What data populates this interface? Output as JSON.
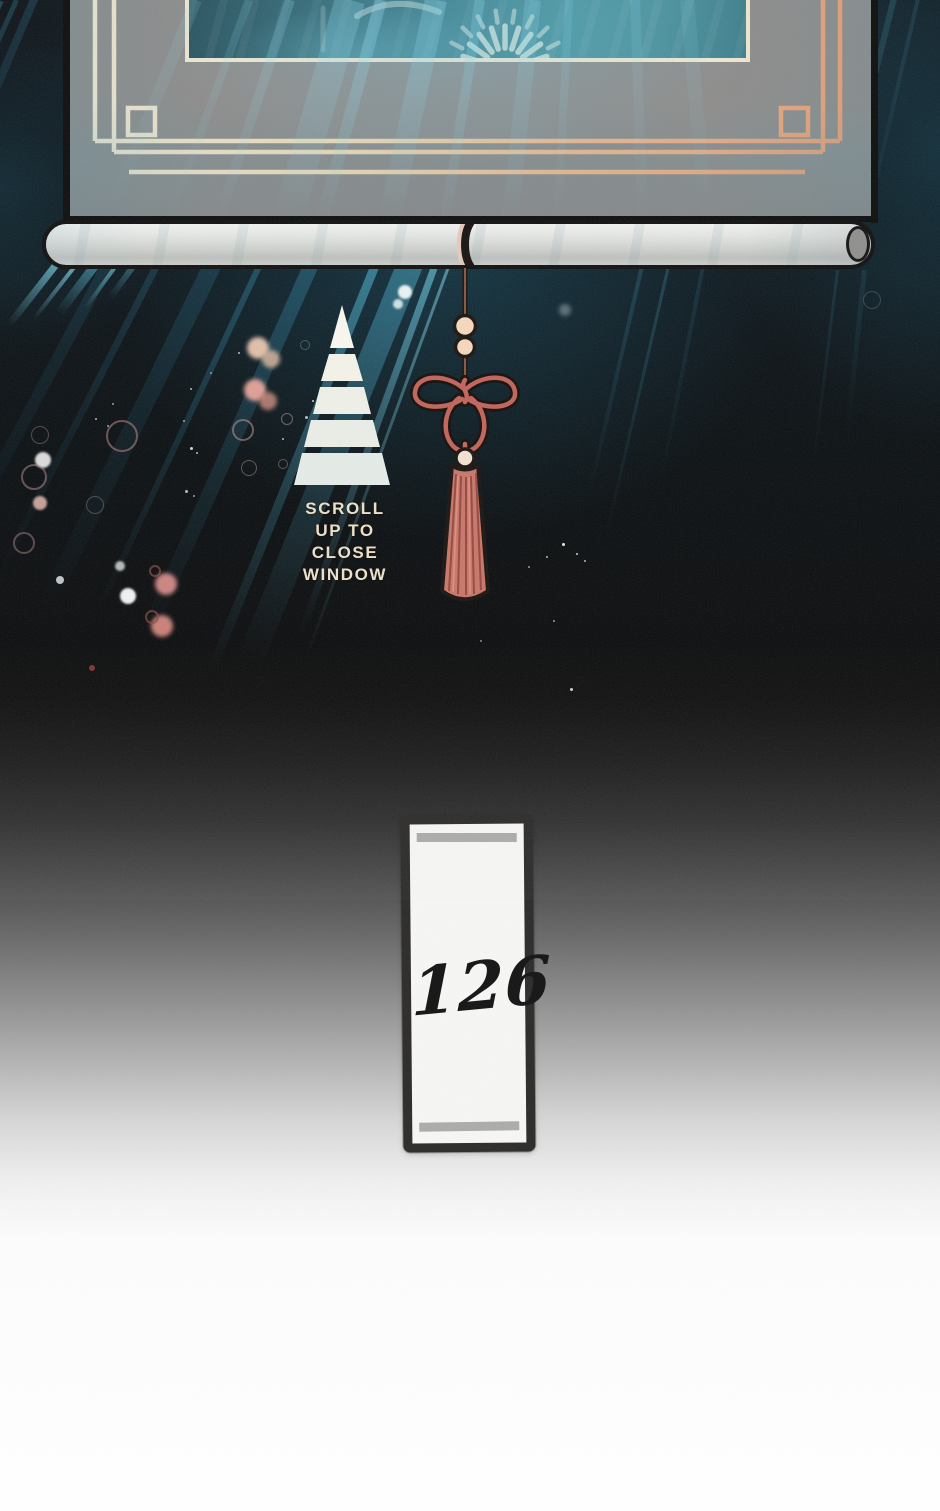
{
  "scene": {
    "hint": {
      "lines": [
        "SCROLL",
        "UP TO",
        "CLOSE",
        "WINDOW"
      ]
    },
    "chapter_tag": {
      "number": "126"
    },
    "icons": {
      "scroll_up_arrow": "stacked-triangle-chevrons",
      "tassel": "knotted-cord-tassel",
      "window_blind": "rolled-up-scroll-blind",
      "window_emblem": "radiating-fan-crest"
    },
    "colors": {
      "ray_cyan": "#56c8eb",
      "frame_gold_left": "#f8eed8",
      "frame_gold_right": "#ef9d72",
      "tassel_rose": "#c2635a",
      "bead_peach": "#f6d9bc",
      "hint_text": "#eee1c9",
      "tag_border": "#2c2b29",
      "tag_paper": "#f7f7f5",
      "window_teal": "#478e9b"
    }
  }
}
